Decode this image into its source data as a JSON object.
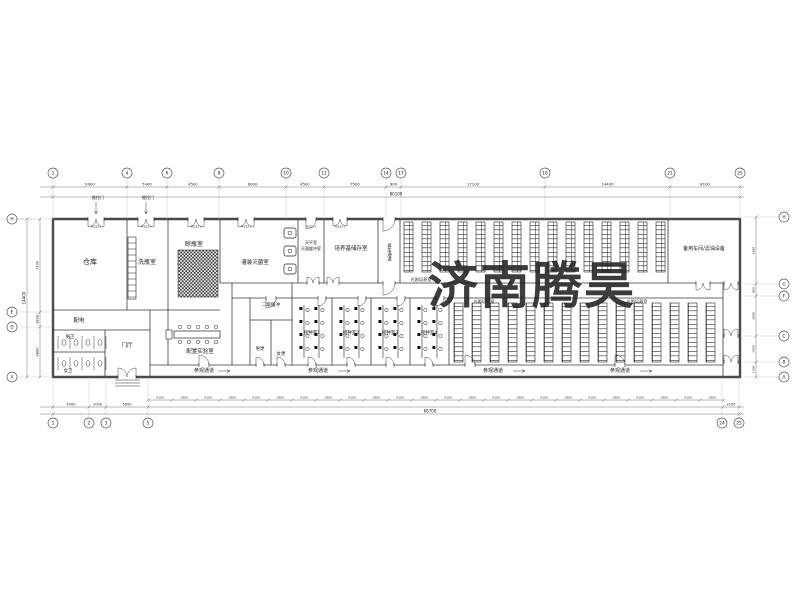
{
  "watermark": {
    "text": "济南腾昊",
    "color": "#e8383d"
  },
  "grid": {
    "top": [
      "1",
      "4",
      "6",
      "8",
      "10",
      "12",
      "14",
      "17",
      "18",
      "21",
      "25"
    ],
    "bottom_left": [
      "1",
      "2",
      "3",
      "5"
    ],
    "bottom_right": [
      "24",
      "25"
    ],
    "left": [
      "H",
      "E",
      "D",
      "A"
    ],
    "right": [
      "H",
      "G",
      "F",
      "C",
      "B",
      "A"
    ]
  },
  "dims": {
    "top": [
      "9900",
      "5400",
      "4500",
      "6000",
      "4500",
      "7500",
      "900",
      "17100",
      "14400",
      "8100"
    ],
    "top_total": "80100",
    "bottom": [
      "2100",
      "1800",
      "2100",
      "1800",
      "2100",
      "1800",
      "2100",
      "1800",
      "2100",
      "1800",
      "2100",
      "1800",
      "2100",
      "1800",
      "2100",
      "1800",
      "2100",
      "1800",
      "2100",
      "1800",
      "2100",
      "1800",
      "2100",
      "1800"
    ],
    "bottom_left": [
      "4300",
      "2000",
      "5000"
    ],
    "bottom_total": "68700",
    "bottom_right": "2100",
    "left": [
      "7200",
      "1800",
      "4800"
    ],
    "left_total": "14400",
    "right": [
      "6600",
      "900",
      "3900",
      "2400",
      "1500"
    ]
  },
  "rooms": {
    "warehouse": "仓库",
    "bottle_washing": "洗瓶室",
    "bottle_drying": "晾瓶室",
    "filling_sterilizing": "灌装灭菌室",
    "balance": "天平室",
    "sterile_buffer": "灭菌缓冲室",
    "medium_storage": "培养基储存室",
    "regen_corridor": "再生通道",
    "light_culture": "光照培养室",
    "spare_workshop": "备用车间/滤油设备",
    "power": "配电",
    "male_wc": "男卫",
    "female_wc": "女卫",
    "lobby": "门厅",
    "prep_lab": "配置实验室",
    "male_change": "男更",
    "female_change": "女更",
    "buffer2": "二级缓冲",
    "inoc1": "接种室1",
    "inoc2": "接种室2",
    "inoc3": "接种室3",
    "inoc4": "接种室4",
    "visitor_corridor": "参观通道"
  },
  "labels": {
    "sliding_door": "推拉门",
    "door_tag": "M1521"
  }
}
